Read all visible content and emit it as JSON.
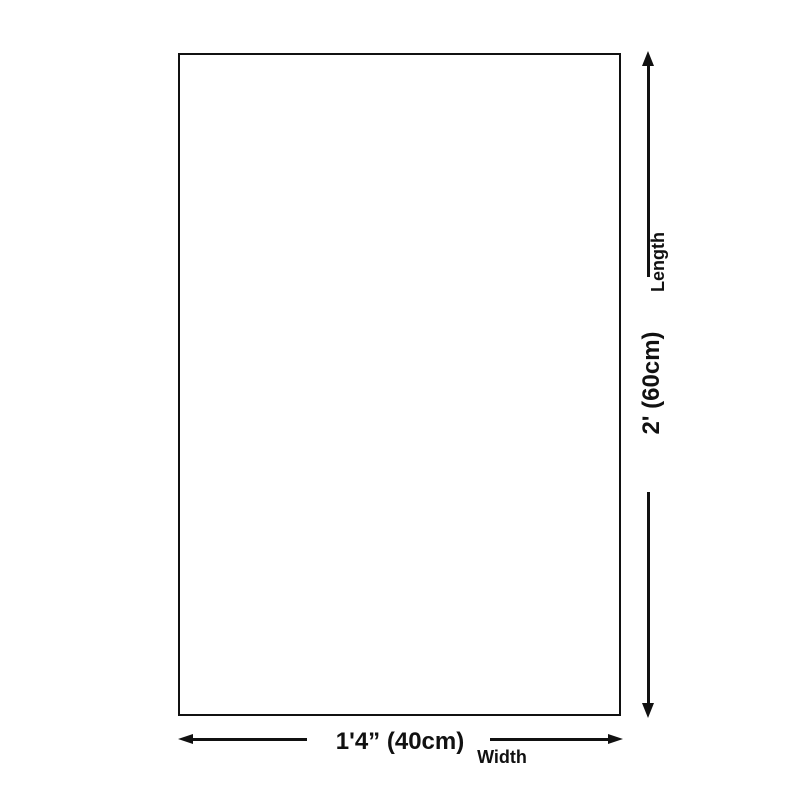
{
  "colors": {
    "background": "#ffffff",
    "line": "#111111"
  },
  "dimensions": {
    "length": {
      "value": "2' (60cm)",
      "label": "Length"
    },
    "width": {
      "value": "1'4” (40cm)",
      "label": "Width"
    }
  }
}
